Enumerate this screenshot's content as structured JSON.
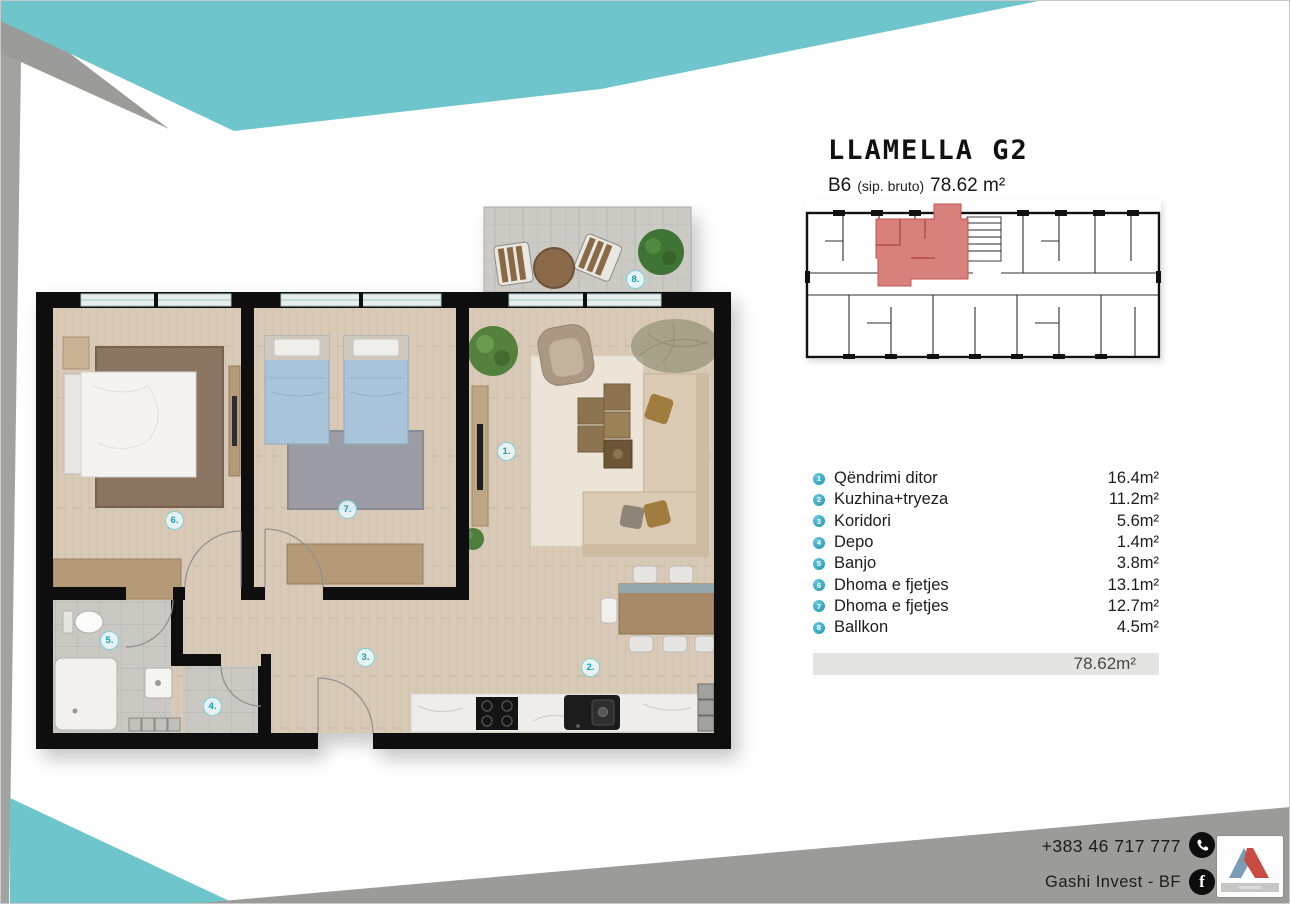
{
  "title": "LLAMELLA G2",
  "subtitle": {
    "unit": "B6",
    "gross_label": "(sip. bruto)",
    "area": "78.62 m²"
  },
  "legend": {
    "rows": [
      {
        "num": "1",
        "label": "Qëndrimi ditor",
        "value": "16.4m²"
      },
      {
        "num": "2",
        "label": "Kuzhina+tryeza",
        "value": "11.2m²"
      },
      {
        "num": "3",
        "label": "Koridori",
        "value": "5.6m²"
      },
      {
        "num": "4",
        "label": "Depo",
        "value": "1.4m²"
      },
      {
        "num": "5",
        "label": "Banjo",
        "value": "3.8m²"
      },
      {
        "num": "6",
        "label": "Dhoma e fjetjes",
        "value": "13.1m²"
      },
      {
        "num": "7",
        "label": "Dhoma e fjetjes",
        "value": "12.7m²"
      },
      {
        "num": "8",
        "label": "Ballkon",
        "value": "4.5m²"
      }
    ],
    "total": "78.62m²"
  },
  "plan": {
    "markers": [
      "1.",
      "2.",
      "3.",
      "4.",
      "5.",
      "6.",
      "7.",
      "8."
    ]
  },
  "contact": {
    "phone": "+383 46 717 777",
    "facebook": "Gashi Invest - BF"
  },
  "colors": {
    "accent_teal": "#6ec6cc",
    "band_gray": "#9b9b99",
    "unit_red": "#d8817c",
    "marker_teal": "#2fb2c4"
  }
}
